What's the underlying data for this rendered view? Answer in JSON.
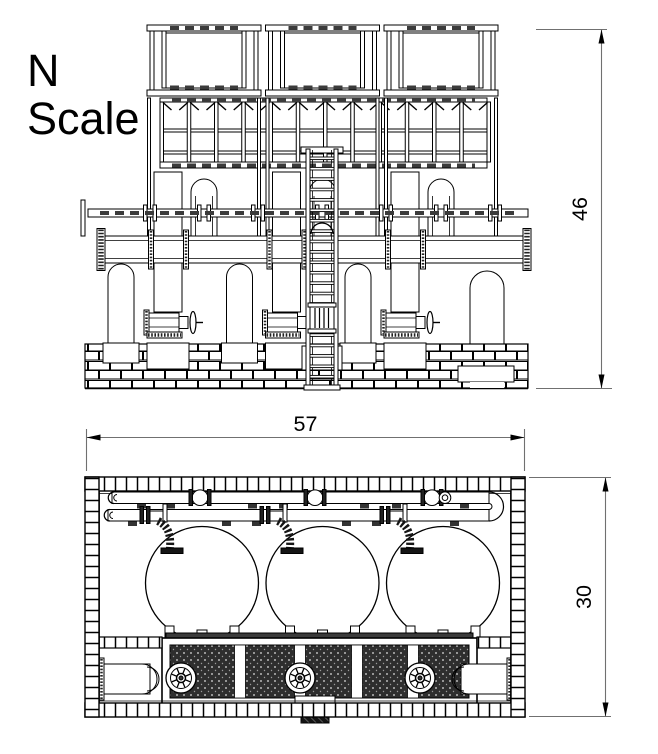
{
  "title_block": {
    "scale_line1": "N",
    "scale_line2": "Scale"
  },
  "views": {
    "elevation": {
      "name": "front-elevation",
      "height_dim": {
        "value": "46"
      }
    },
    "plan": {
      "name": "plan-view",
      "width_dim": {
        "value": "57"
      },
      "depth_dim": {
        "value": "30"
      }
    }
  },
  "colors": {
    "line": "#000000",
    "dim_line": "#707070",
    "dark_fill": "#2e2e2e",
    "background": "#ffffff"
  }
}
